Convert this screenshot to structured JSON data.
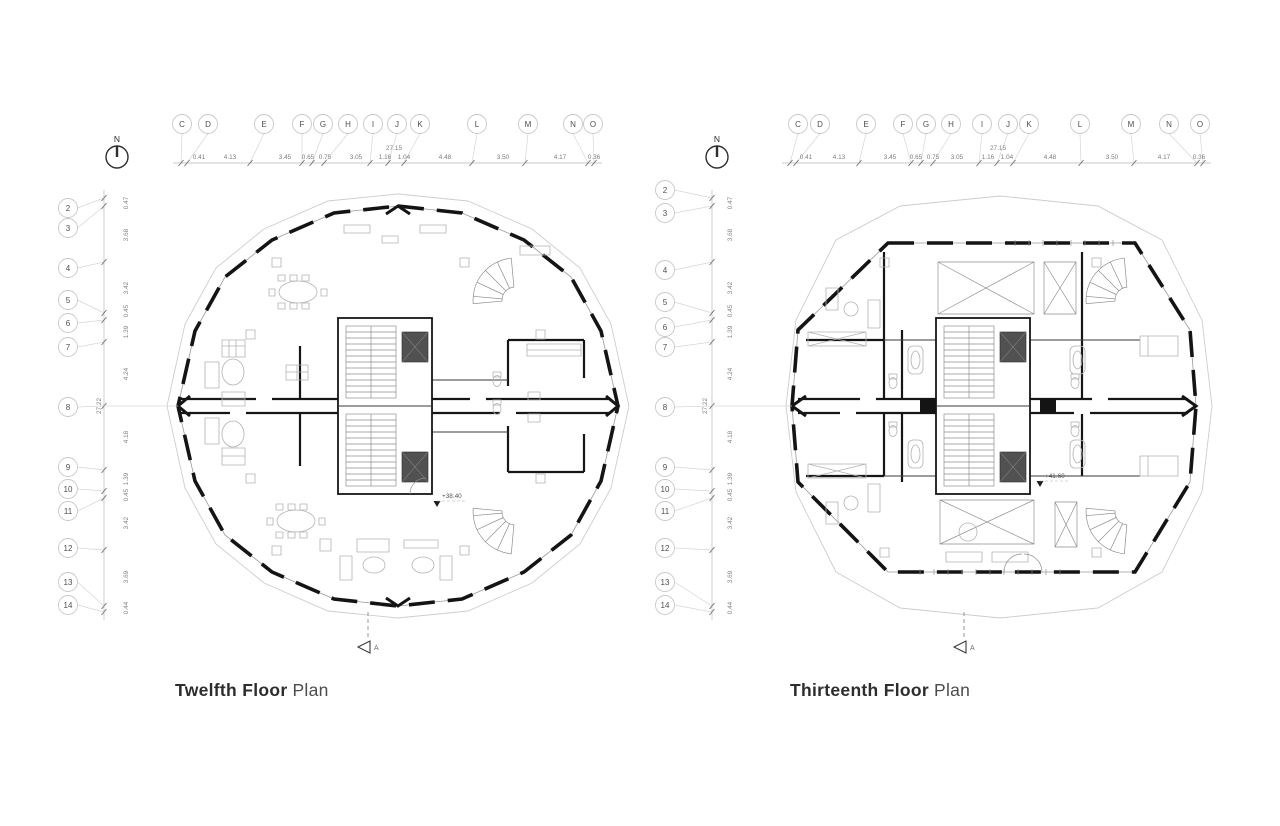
{
  "sheet": {
    "background": "#ffffff",
    "line_color": "#141414",
    "annotation_color": "#7d7d7d"
  },
  "plans": [
    {
      "title_bold": "Twelfth Floor",
      "title_regular": "Plan",
      "level_mark": "+38.40",
      "north_label": "N",
      "section_label": "A",
      "column_axes": [
        "C",
        "D",
        "E",
        "F",
        "G",
        "H",
        "I",
        "J",
        "K",
        "L",
        "M",
        "N",
        "O"
      ],
      "column_dims": [
        "0.41",
        "4.13",
        "3.45",
        "0.65",
        "0.75",
        "3.05",
        "1.16",
        "1.04",
        "4.48",
        "3.50",
        "4.17",
        "0.36"
      ],
      "column_total": "27.15",
      "row_axes": [
        "2",
        "3",
        "4",
        "5",
        "6",
        "7",
        "8",
        "9",
        "10",
        "11",
        "12",
        "13",
        "14"
      ],
      "row_dims": [
        "0.47",
        "3.68",
        "3.42",
        "0.45",
        "1.39",
        "4.24",
        "4.18",
        "1.39",
        "0.45",
        "3.42",
        "3.69",
        "0.44"
      ],
      "row_total": "27.22"
    },
    {
      "title_bold": "Thirteenth Floor",
      "title_regular": "Plan",
      "level_mark": "+41.60",
      "north_label": "N",
      "section_label": "A",
      "column_axes": [
        "C",
        "D",
        "E",
        "F",
        "G",
        "H",
        "I",
        "J",
        "K",
        "L",
        "M",
        "N",
        "O"
      ],
      "column_dims": [
        "0.41",
        "4.13",
        "3.45",
        "0.65",
        "0.75",
        "3.05",
        "1.16",
        "1.04",
        "4.48",
        "3.50",
        "4.17",
        "0.36"
      ],
      "column_total": "27.15",
      "row_axes": [
        "2",
        "3",
        "4",
        "5",
        "6",
        "7",
        "8",
        "9",
        "10",
        "11",
        "12",
        "13",
        "14"
      ],
      "row_dims": [
        "0.47",
        "3.68",
        "3.42",
        "0.45",
        "1.39",
        "4.24",
        "4.18",
        "1.39",
        "0.45",
        "3.42",
        "3.69",
        "0.44"
      ],
      "row_total": "27.22"
    }
  ]
}
